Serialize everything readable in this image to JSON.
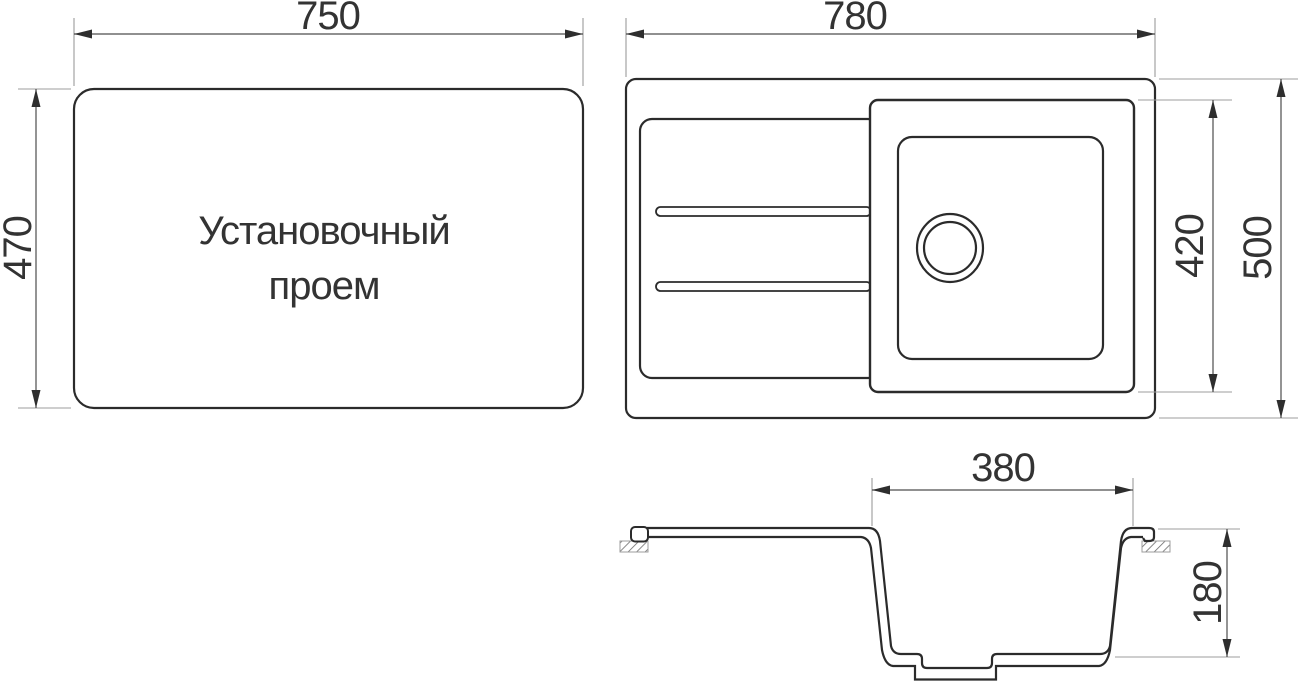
{
  "drawing": {
    "views": {
      "installation_opening": {
        "label_line1": "Установочный",
        "label_line2": "проем",
        "width_label": "750",
        "height_label": "470"
      },
      "top_view": {
        "width_label": "780",
        "overall_depth_label": "500",
        "bowl_module_height_label": "420"
      },
      "section_view": {
        "bowl_width_label": "380",
        "bowl_depth_label": "180"
      }
    },
    "colors": {
      "outline": "#2b2b2b",
      "dimension_line": "#4d4d4d",
      "extension_line": "#9c9c9c",
      "arrow": "#2e2e2e",
      "text": "#333333",
      "background": "#ffffff"
    }
  }
}
